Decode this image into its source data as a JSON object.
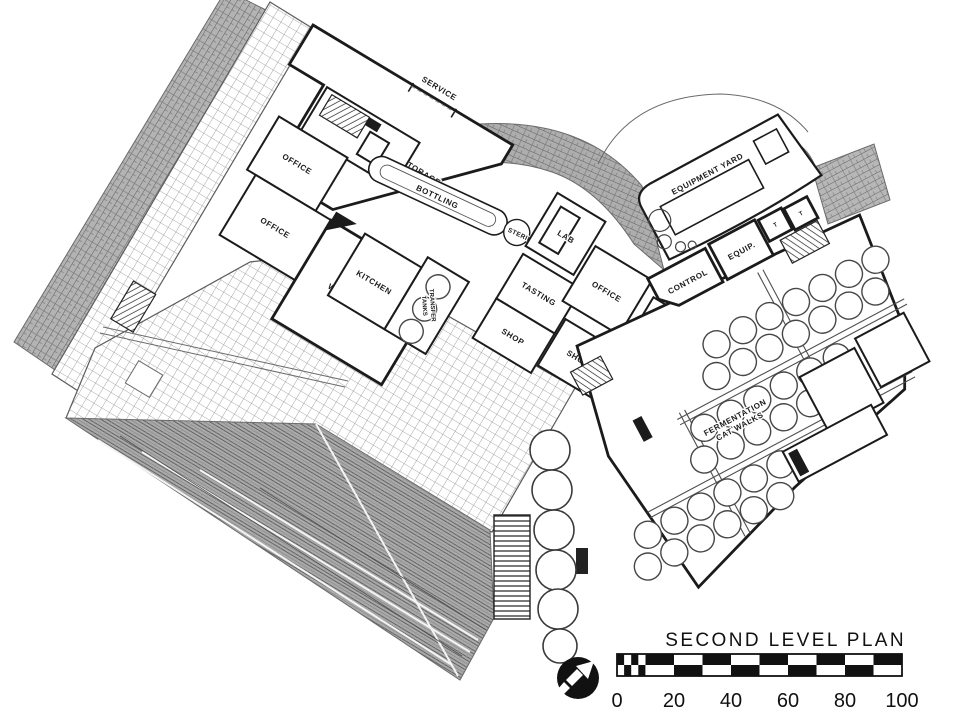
{
  "title": "SECOND LEVEL PLAN",
  "scale_bar": {
    "ticks": [
      "0",
      "20",
      "40",
      "60",
      "80",
      "100"
    ]
  },
  "north_arrow": {
    "icon": "north-arrow-icon",
    "direction": "north-east"
  },
  "labels": {
    "service": "SERVICE",
    "case_storage": "CASE STORAGE",
    "bottling": "BOTTLING",
    "sterilizing": "STERILIZING",
    "kitchen": "KITCHEN",
    "transfer_tanks_1": "TRANSFER",
    "transfer_tanks_2": "TANKS",
    "tasting": "TASTING",
    "shop_upper": "SHOP",
    "shop_lower": "SHOP",
    "lab": "LAB",
    "office_nw_1": "OFFICE",
    "office_nw_2": "OFFICE",
    "office_east": "OFFICE",
    "wine_tasting": "WINE TASTING",
    "lunch_room_1": "LUNCH",
    "lunch_room_2": "ROOM",
    "control": "CONTROL",
    "equip": "EQUIP.",
    "equipment_yard": "EQUIPMENT YARD",
    "fermentation_1": "FERMENTATION",
    "fermentation_2": "CAT WALKS",
    "toilet_1": "T",
    "toilet_2": "T"
  },
  "colors": {
    "ink": "#1b1b1b",
    "paper": "#ffffff",
    "roof_gray": "#b0b0b0",
    "band_gray": "#b3b3b3",
    "grid_line": "#8f8f8f"
  }
}
